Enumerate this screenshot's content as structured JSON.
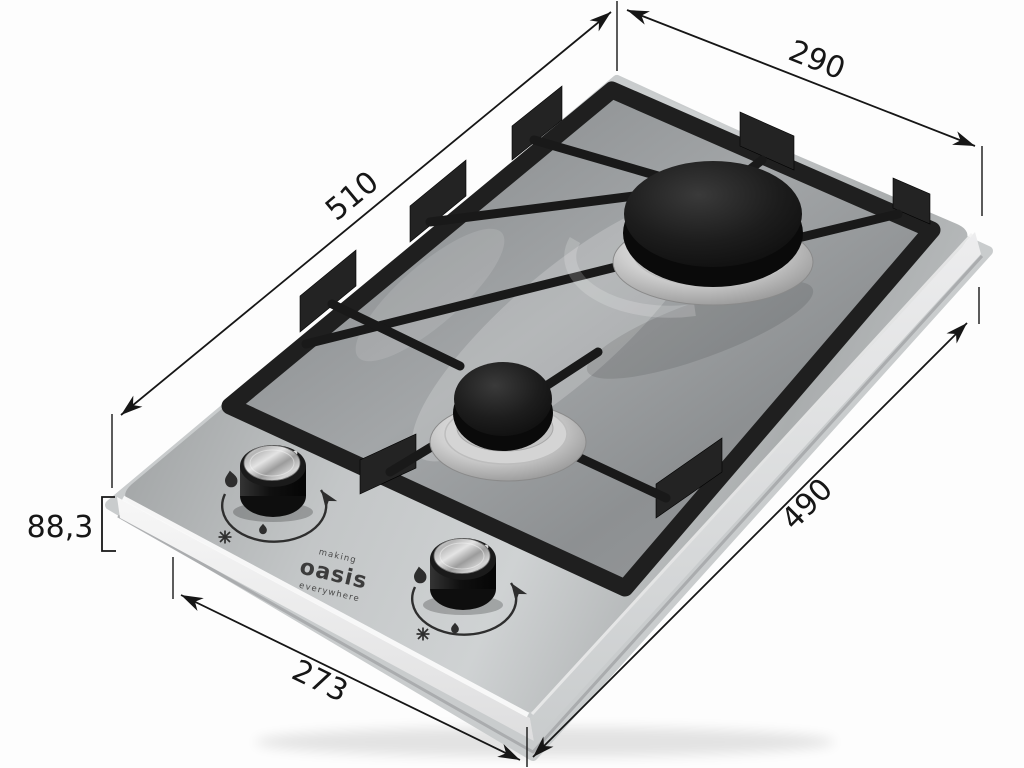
{
  "figure": {
    "type": "product dimension photo",
    "subject": "Two-burner built-in domino gas hob with cast-iron pan supports shown in perspective with overall dimension callouts",
    "background": "#fdfdfd"
  },
  "dims": {
    "back_width": "290",
    "left_depth": "510",
    "right_depth": "490",
    "front_width": "273",
    "height": "88,3"
  },
  "brand": {
    "top": "making",
    "name": "oasis",
    "bottom": "everywhere"
  },
  "knob_icons": {
    "high": "flame-high",
    "low": "flame-low",
    "ignite": "ignition-spark"
  },
  "colors": {
    "annotation": "#161616",
    "steel": "#b3b6b7",
    "steel_recessed": "#8d9092",
    "grate_black": "#1f1f1f",
    "burner_cap": "#141414",
    "aluminum": "#d8d8d8",
    "brass": "#a9852f",
    "tray": "#c9cccd",
    "background": "#fdfdfd"
  }
}
